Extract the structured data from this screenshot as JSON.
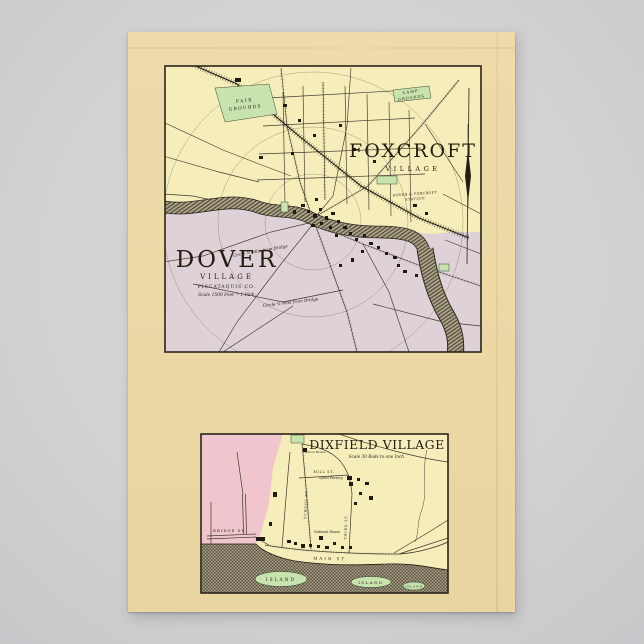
{
  "colors": {
    "background_grey": "#d2d2d4",
    "poster_cream": "#ecd9a6",
    "map_yellow": "#f5eeba",
    "map_lavender": "#ded2d8",
    "map_pink": "#f1c5cd",
    "map_green": "#c8e3ad",
    "river_base": "#aaa385",
    "ink": "#2b241a"
  },
  "icons": {
    "north_arrow": "north-arrow-icon"
  },
  "top_map": {
    "foxcroft_title": "FOXCROFT",
    "foxcroft_subtitle": "VILLAGE",
    "dover_title": "DOVER",
    "dover_subtitle": "VILLAGE",
    "dover_county": "PISCATAQUIS CO.",
    "dover_scale": "Scale 1500 Feet = 1 Inch.",
    "fair_grounds_line1": "FAIR",
    "fair_grounds_line2": "GROUNDS",
    "camp_grounds_line1": "CAMP",
    "camp_grounds_line2": "GROUNDS",
    "station_line1": "DOVER & FOXCROFT",
    "station_line2": "STATION",
    "arc_label_inner": "Circle ½ Mile from Bridge",
    "arc_label_outer": "Circle ¾ Mile from Bridge"
  },
  "bottom_map": {
    "title": "DIXFIELD VILLAGE",
    "scale": "Scale 30 Rods to one Inch.",
    "streets": {
      "bridge": "BRIDGE ST.",
      "main": "MAIN ST.",
      "mill": "MILL ST.",
      "school": "SCHOOL ST.",
      "third": "THIRD ST."
    },
    "labels": {
      "spool_factory": "Spool Factory",
      "national_house": "National House",
      "school_house": "School House",
      "island_1": "ISLAND",
      "island_2": "ISLAND",
      "island_3": "ISLAND"
    }
  }
}
